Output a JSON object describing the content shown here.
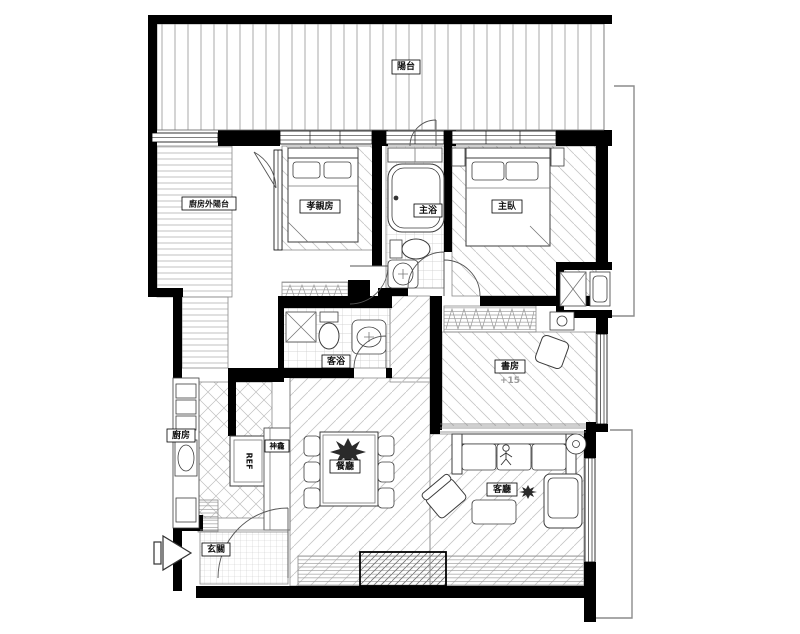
{
  "page": {
    "title": "Apartment floor plan drawing"
  },
  "floor_plan": {
    "rooms": {
      "balcony": "陽台",
      "outer_balcony": "廚房外陽台",
      "parents_room": "孝親房",
      "master_bath": "主浴",
      "master_bedroom": "主臥",
      "guest_bath": "客浴",
      "study": "書房",
      "study_floor_level": "+15",
      "kitchen": "廚房",
      "shrine_cabinet": "神龕",
      "refrigerator": "REF",
      "dining_room": "餐廳",
      "living_room": "客廳",
      "entry": "玄關"
    },
    "colors": {
      "wall": "#000000",
      "line": "#444444",
      "hatch": "#c9c9c9",
      "background": "#ffffff"
    }
  }
}
